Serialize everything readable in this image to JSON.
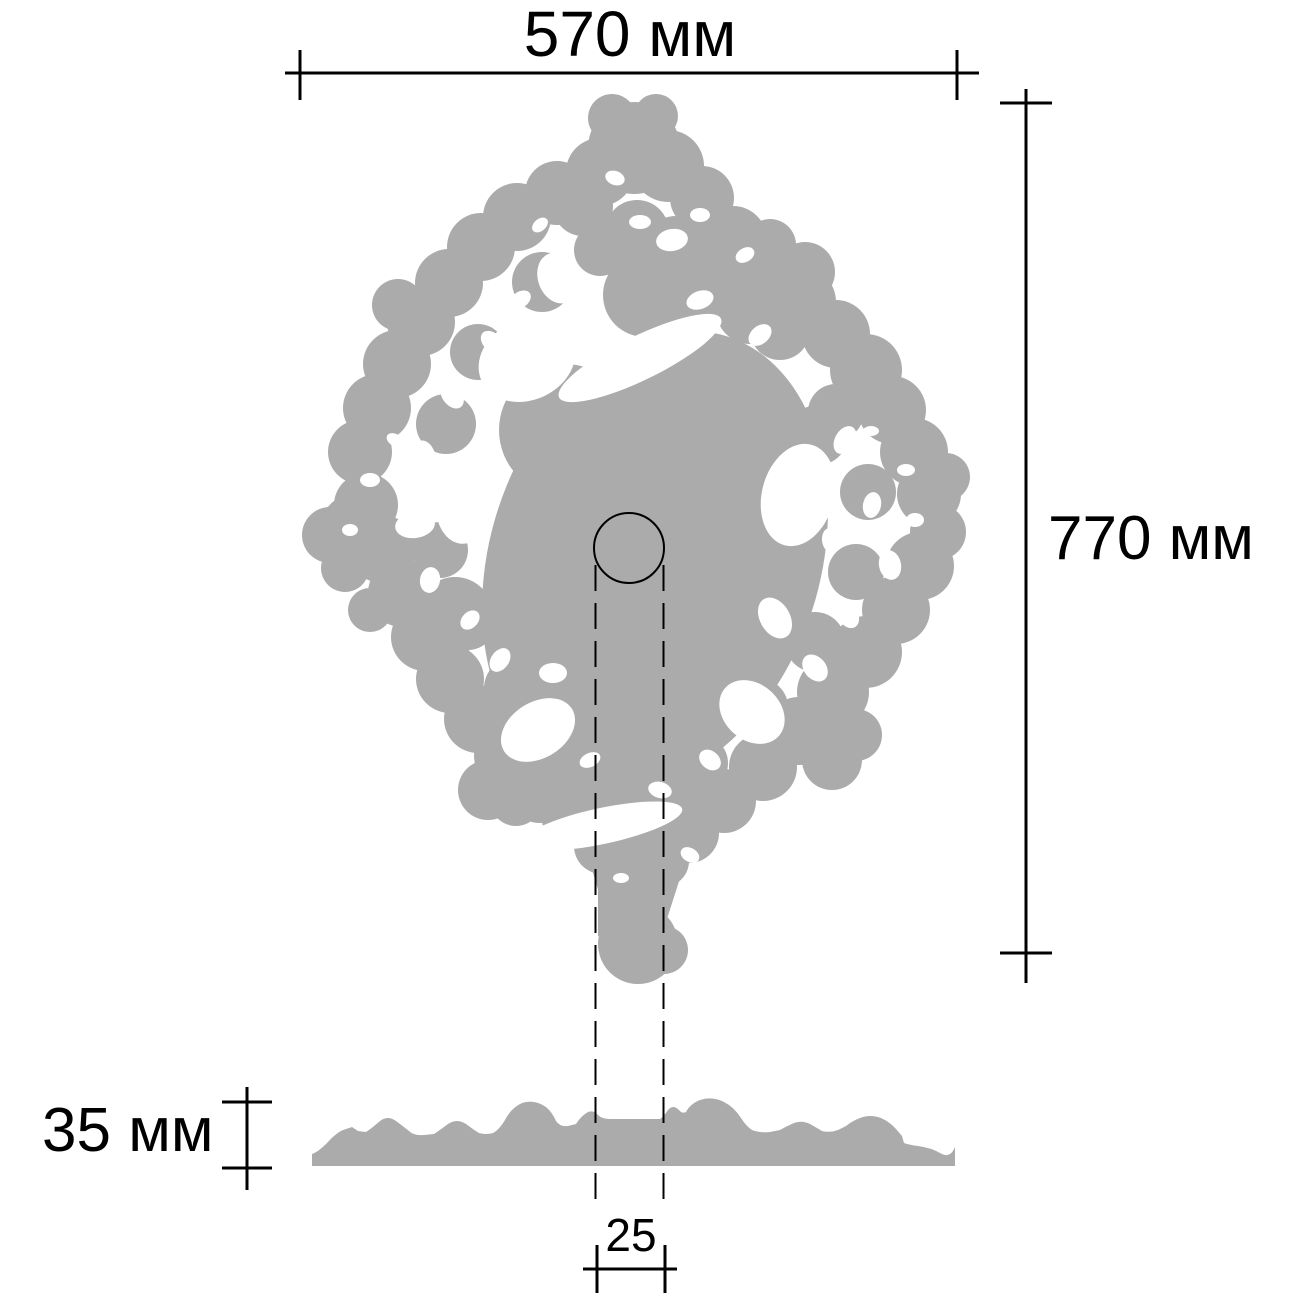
{
  "labels": {
    "width": "570 мм",
    "height": "770 мм",
    "thickness": "35 мм",
    "hole_offset": "25"
  },
  "colors": {
    "silhouette": "#ababab",
    "cutout": "#ffffff",
    "line": "#000000",
    "background": "#ffffff"
  }
}
